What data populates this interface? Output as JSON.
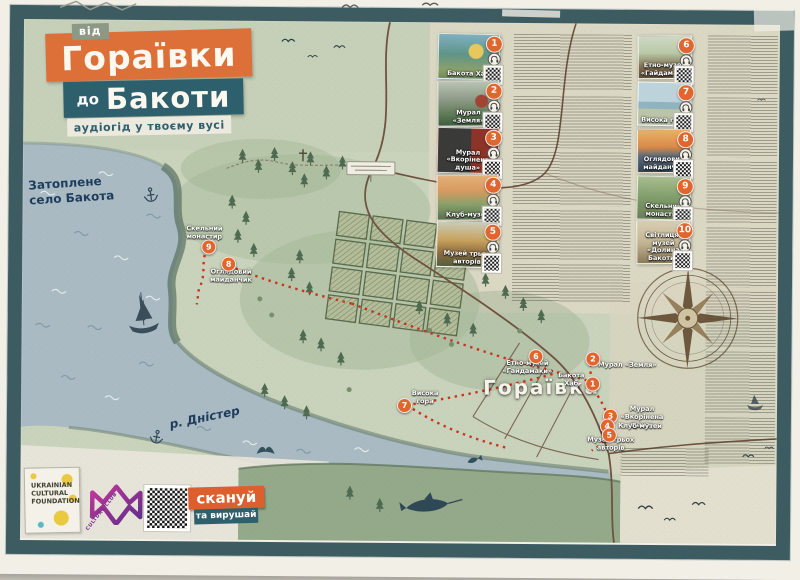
{
  "title": {
    "prefix": "від",
    "main": "Гораївки",
    "secondary_prefix": "до",
    "secondary": "Бакоти",
    "tagline": "аудіогід у твоєму вусі"
  },
  "map_labels": {
    "flooded_village": "Затоплене село Бакота",
    "river": "р. Дністер",
    "village": "Гораївка"
  },
  "markers": [
    {
      "number": "1",
      "label": "Бакота Хаб"
    },
    {
      "number": "2",
      "label": "Мурал «Земля»"
    },
    {
      "number": "3",
      "label": "Мурал «Вкорінена душа»"
    },
    {
      "number": "4",
      "label": "Клуб-музей"
    },
    {
      "number": "5",
      "label": "Музей трьох авторів"
    },
    {
      "number": "6",
      "label": "Етно-музей «Гайдамаки»"
    },
    {
      "number": "7",
      "label": "Висока гора"
    },
    {
      "number": "8",
      "label": "Оглядовий майданчик"
    },
    {
      "number": "9",
      "label": "Скельний монастир"
    }
  ],
  "pois": [
    {
      "number": "1",
      "caption": "Бакота Хаб"
    },
    {
      "number": "2",
      "caption": "Мурал «Земля»"
    },
    {
      "number": "3",
      "caption": "Мурал «Вкорінена душа»"
    },
    {
      "number": "4",
      "caption": "Клуб-музей"
    },
    {
      "number": "5",
      "caption": "Музей трьох авторів"
    },
    {
      "number": "6",
      "caption": "Етно-музей «Гайдамаки»"
    },
    {
      "number": "7",
      "caption": "Висока гора"
    },
    {
      "number": "8",
      "caption": "Оглядовий майданчик"
    },
    {
      "number": "9",
      "caption": "Скельний монастир"
    },
    {
      "number": "10",
      "caption": "Світлиця-музей «Долина Бакоти»"
    }
  ],
  "footer": {
    "scan_button": "скануй",
    "scan_sub": "та вирушай",
    "ucf_logo_line1": "UKRAINIAN",
    "ucf_logo_line2": "CULTURAL",
    "ucf_logo_line3": "FOUNDATION",
    "club_logo": "CULTURE CLUB"
  }
}
